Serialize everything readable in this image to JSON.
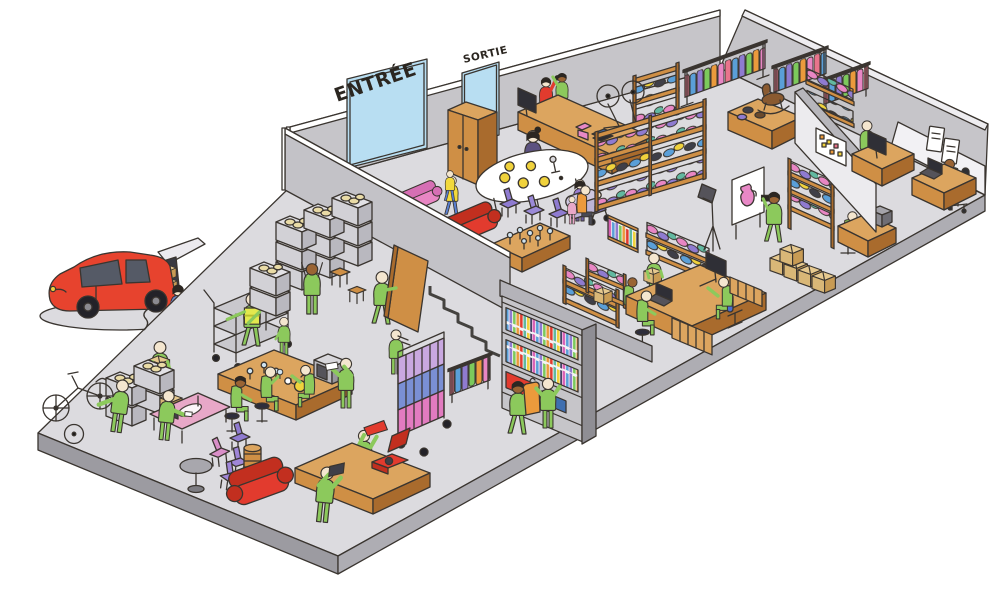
{
  "signs": {
    "entrance": "ENTRÉE",
    "exit": "SORTIE"
  },
  "palette": {
    "worker_green": "#8cc95c",
    "car_red": "#e7432e",
    "door_glass_blue": "#b8def2",
    "wood_brown": "#cf8f45",
    "floor_gray": "#dcdbdf",
    "wall_gray": "#c6c5c9",
    "sofa_red": "#e23b2e",
    "sofa_pink": "#e886c4",
    "chair_purple": "#8f7bd0",
    "crate_gray": "#d2d1d6",
    "cardboard_tan": "#d9b777"
  }
}
